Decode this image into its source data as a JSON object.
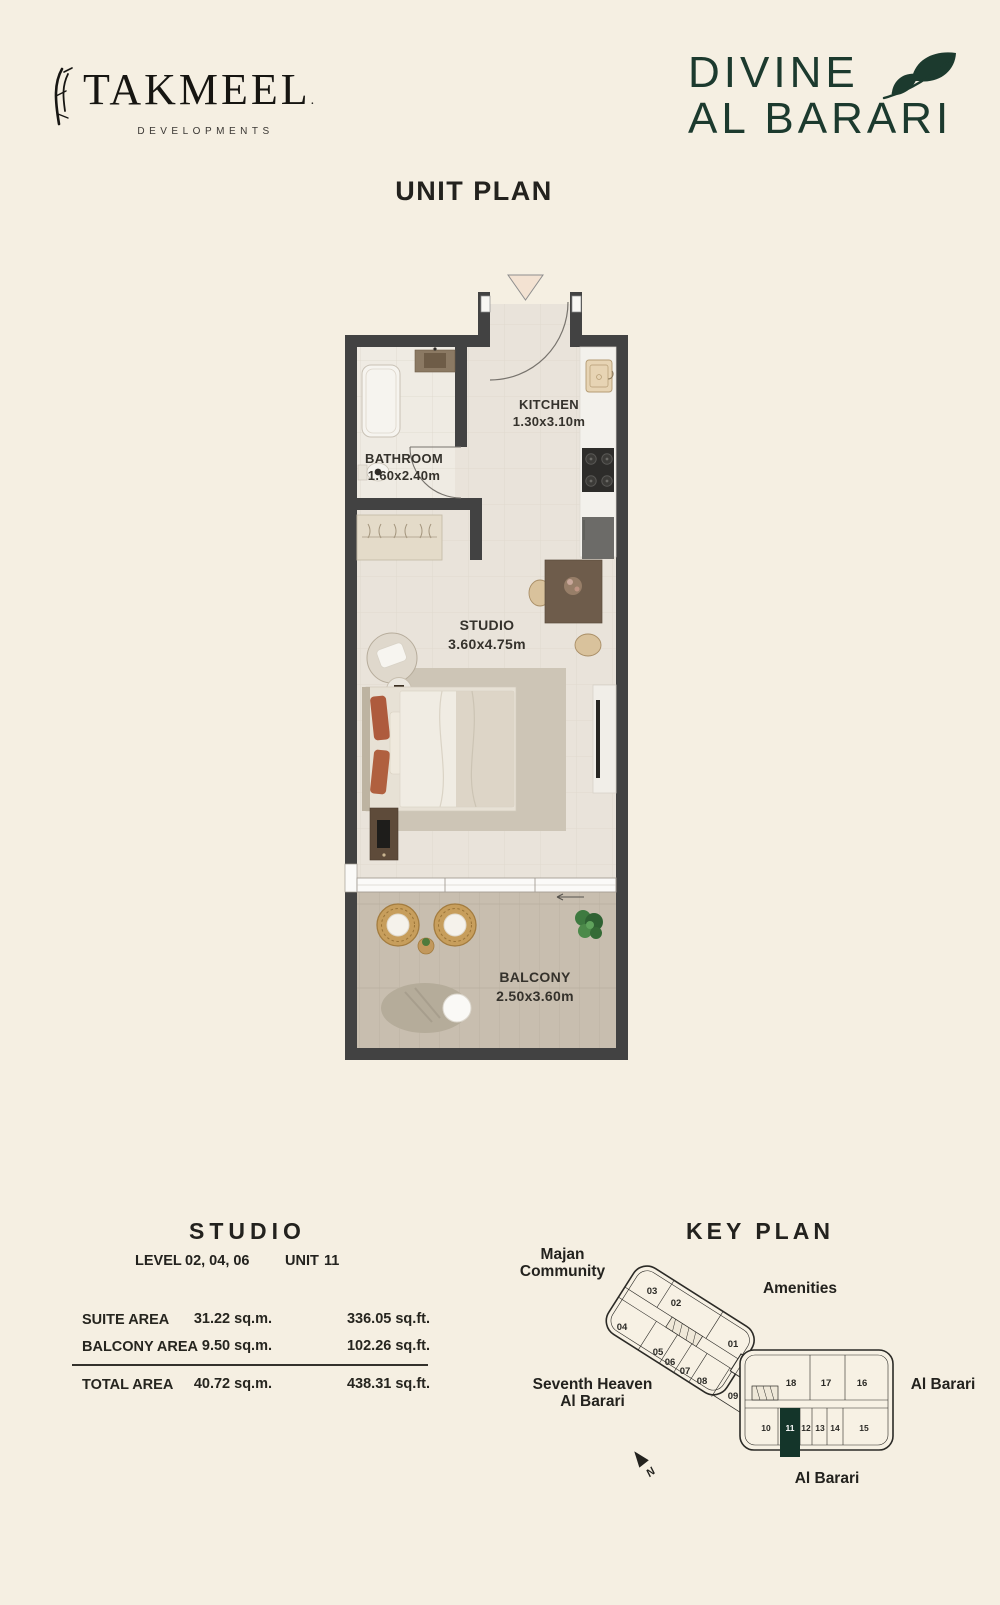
{
  "colors": {
    "background": "#F5EFE2",
    "ink": "#23221E",
    "brand_green": "#1C3A2E",
    "wall": "#424242",
    "floor": "#E9E3DA",
    "deck": "#C8BEAF",
    "unit_highlight": "#14352A"
  },
  "header": {
    "takmeel": {
      "name": "TAKMEEL",
      "reg": ".",
      "tagline": "DEVELOPMENTS"
    },
    "divine": {
      "line1": "DIVINE",
      "line2": "AL BARARI"
    }
  },
  "title": "UNIT PLAN",
  "plan": {
    "kitchen": {
      "name": "KITCHEN",
      "dims": "1.30x3.10m"
    },
    "bathroom": {
      "name": "BATHROOM",
      "dims": "1.60x2.40m"
    },
    "studio": {
      "name": "STUDIO",
      "dims": "3.60x4.75m"
    },
    "balcony": {
      "name": "BALCONY",
      "dims": "2.50x3.60m"
    }
  },
  "details": {
    "heading": "STUDIO",
    "level_label": "LEVEL",
    "level_value": "02, 04, 06",
    "unit_label": "UNIT",
    "unit_value": "11",
    "areas": [
      {
        "label": "SUITE AREA",
        "sqm": "31.22 sq.m.",
        "sqft": "336.05 sq.ft."
      },
      {
        "label": "BALCONY AREA",
        "sqm": "9.50 sq.m.",
        "sqft": "102.26 sq.ft."
      },
      {
        "label": "TOTAL AREA",
        "sqm": "40.72 sq.m.",
        "sqft": "438.31 sq.ft."
      }
    ]
  },
  "keyplan": {
    "heading": "KEY PLAN",
    "labels": {
      "majan": [
        "Majan",
        "Community"
      ],
      "amenities": "Amenities",
      "seventh": [
        "Seventh Heaven",
        "Al Barari"
      ],
      "albarari_right": "Al Barari",
      "albarari_bottom": "Al Barari"
    },
    "north": "N",
    "units_left": [
      "03",
      "02",
      "01",
      "04",
      "05",
      "06",
      "07",
      "08",
      "09"
    ],
    "units_right_top": [
      "18",
      "17",
      "16"
    ],
    "units_right_bottom": [
      "10",
      "11",
      "12",
      "13",
      "14",
      "15"
    ],
    "highlighted_unit": "11"
  }
}
